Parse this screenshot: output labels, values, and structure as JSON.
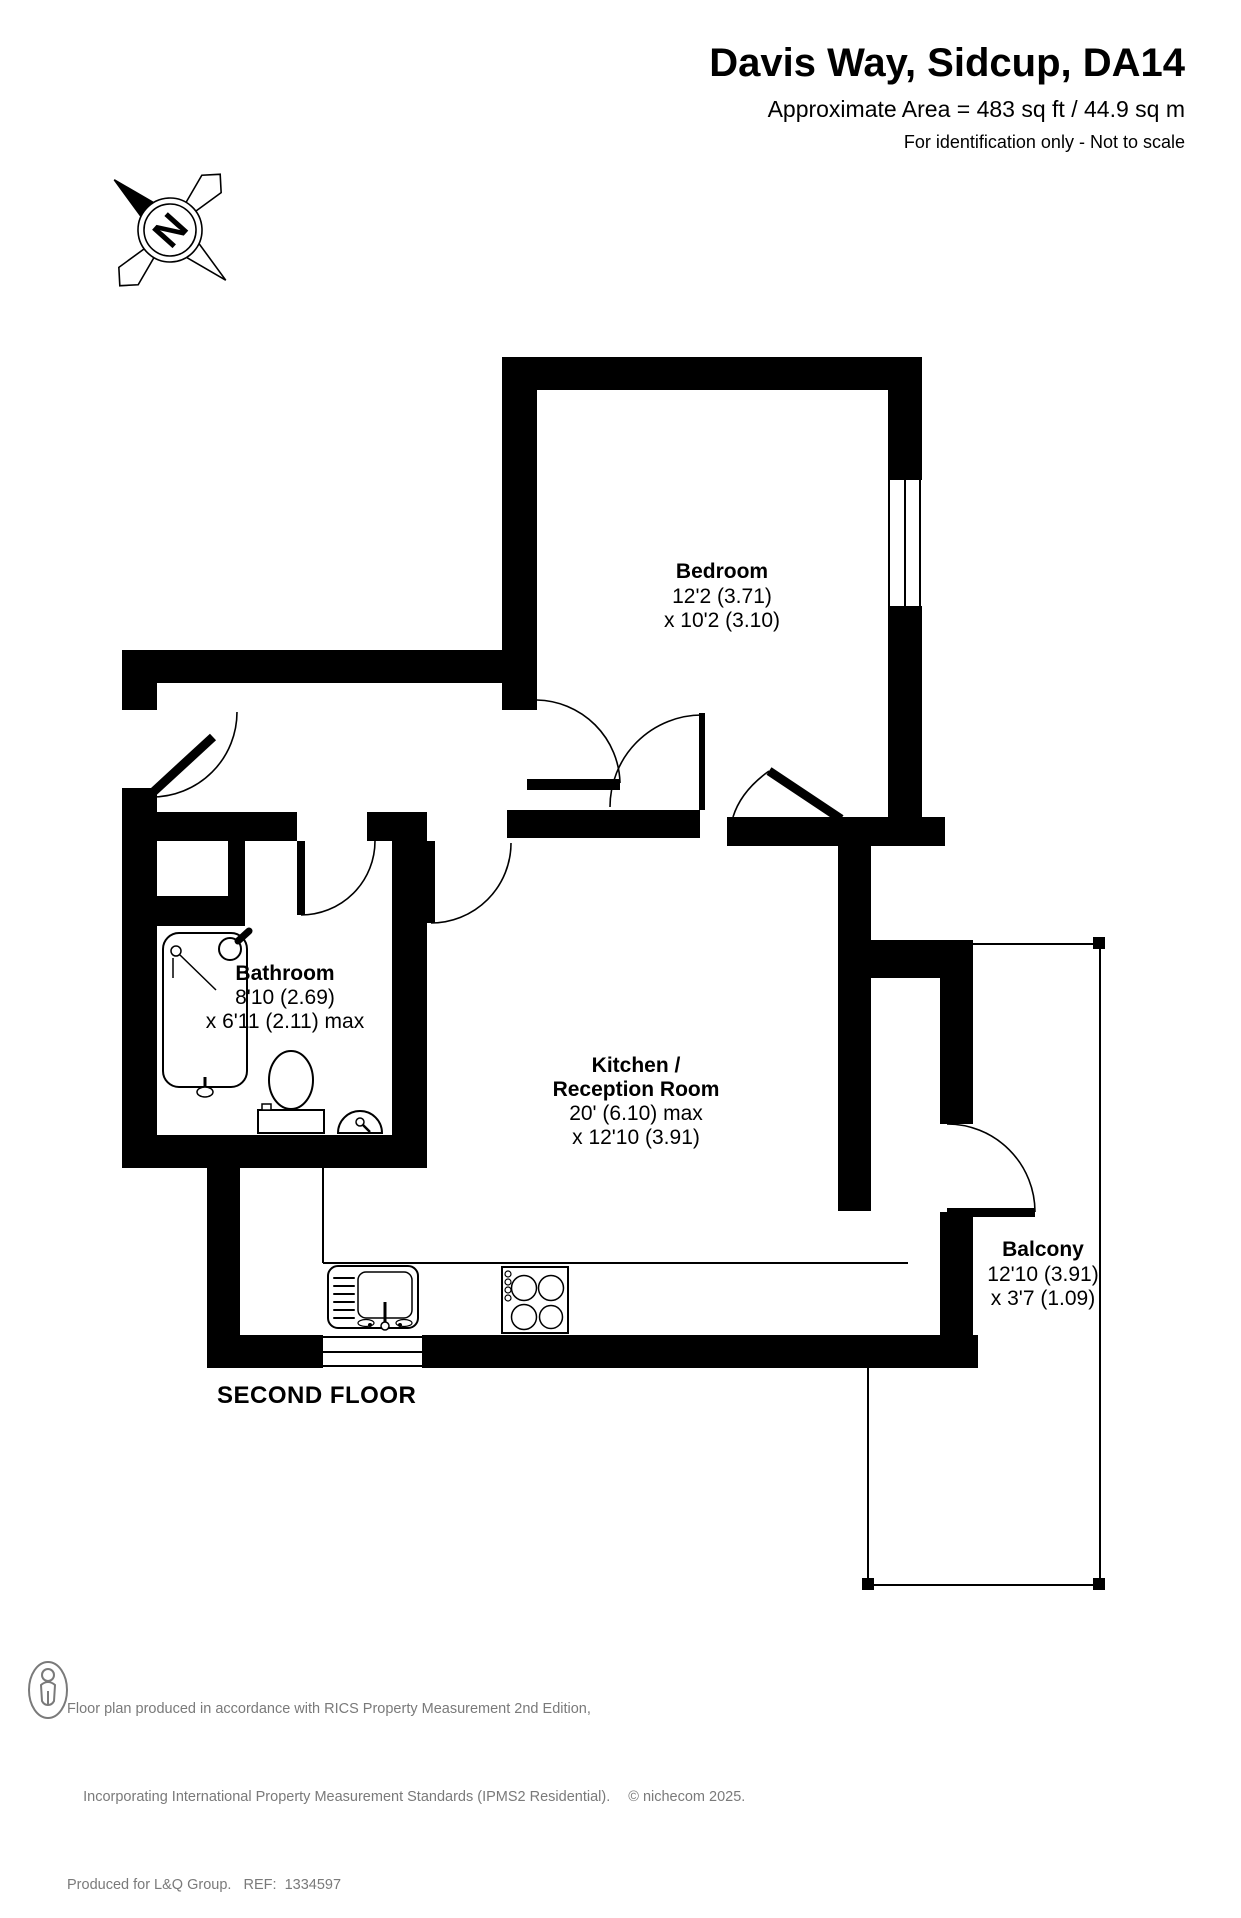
{
  "header": {
    "title": "Davis Way, Sidcup, DA14",
    "area_line": "Approximate Area = 483 sq ft / 44.9 sq m",
    "disclaimer": "For identification only - Not to scale"
  },
  "compass": {
    "letter": "N"
  },
  "floor_label": "SECOND FLOOR",
  "rooms": {
    "bedroom": {
      "name": "Bedroom",
      "dim1": "12'2 (3.71)",
      "dim2": "x 10'2 (3.10)"
    },
    "bathroom": {
      "name": "Bathroom",
      "dim1": "8'10 (2.69)",
      "dim2": "x 6'11 (2.11) max"
    },
    "kitchen": {
      "name1": "Kitchen /",
      "name2": "Reception Room",
      "dim1": "20' (6.10) max",
      "dim2": "x 12'10 (3.91)"
    },
    "balcony": {
      "name": "Balcony",
      "dim1": "12'10 (3.91)",
      "dim2": "x 3'7 (1.09)"
    }
  },
  "footer": {
    "line1": "Floor plan produced in accordance with RICS Property Measurement 2nd Edition,",
    "line2": "Incorporating International Property Measurement Standards (IPMS2 Residential).",
    "copyright": "© nichecom 2025.",
    "line3": "Produced for L&Q Group.   REF:  1334597"
  },
  "colors": {
    "wall": "#000000",
    "footer_text": "#7a7a7a",
    "background": "#ffffff"
  }
}
